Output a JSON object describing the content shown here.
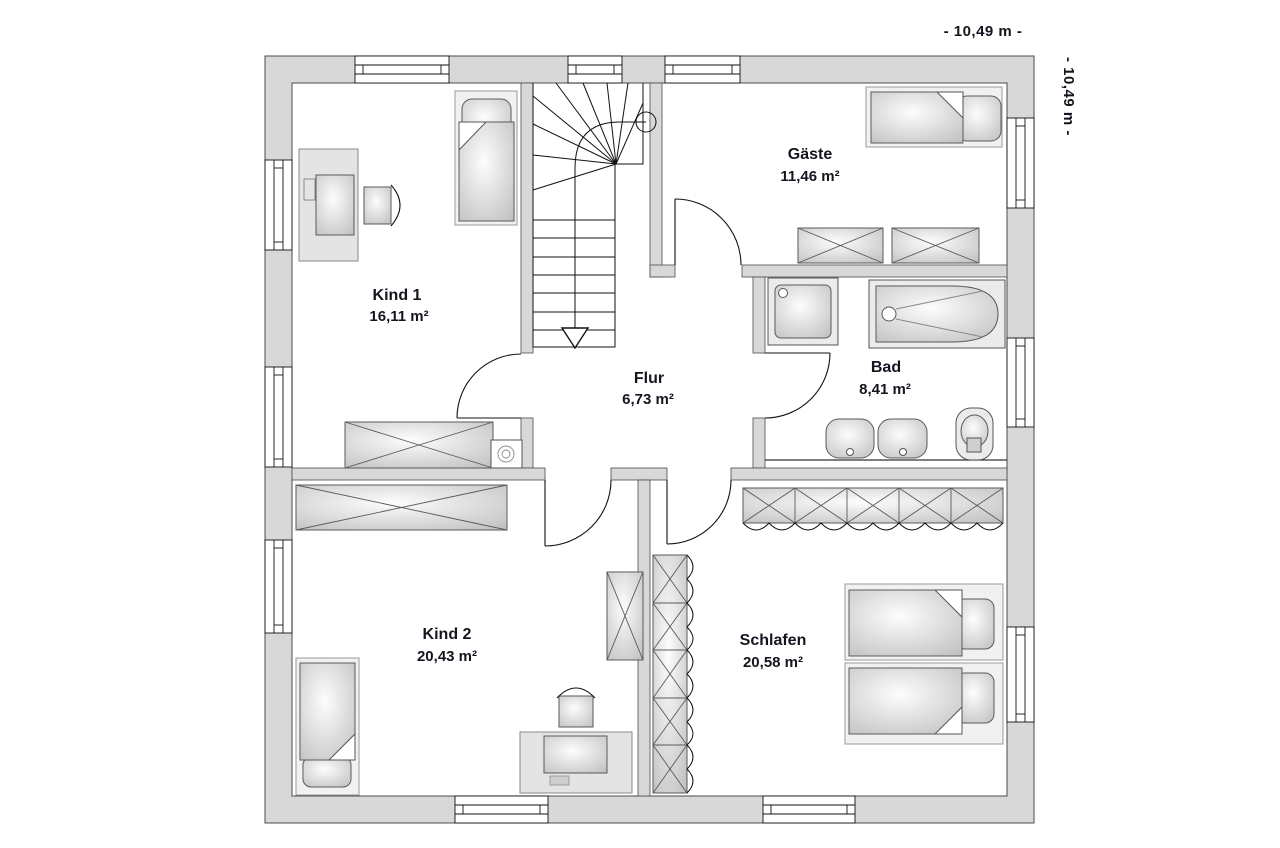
{
  "plan": {
    "title": "floor-plan-upper-storey",
    "dimension_top": "- 10,49 m -",
    "dimension_right": "- 10,49 m -",
    "rooms": [
      {
        "name": "Kind 1",
        "area": "16,11 m²"
      },
      {
        "name": "Gäste",
        "area": "11,46 m²"
      },
      {
        "name": "Flur",
        "area": "6,73 m²"
      },
      {
        "name": "Bad",
        "area": "8,41 m²"
      },
      {
        "name": "Kind 2",
        "area": "20,43 m²"
      },
      {
        "name": "Schlafen",
        "area": "20,58 m²"
      }
    ],
    "colors": {
      "wall": "#d8d8d8",
      "line": "#111111",
      "text": "#15151f"
    }
  }
}
